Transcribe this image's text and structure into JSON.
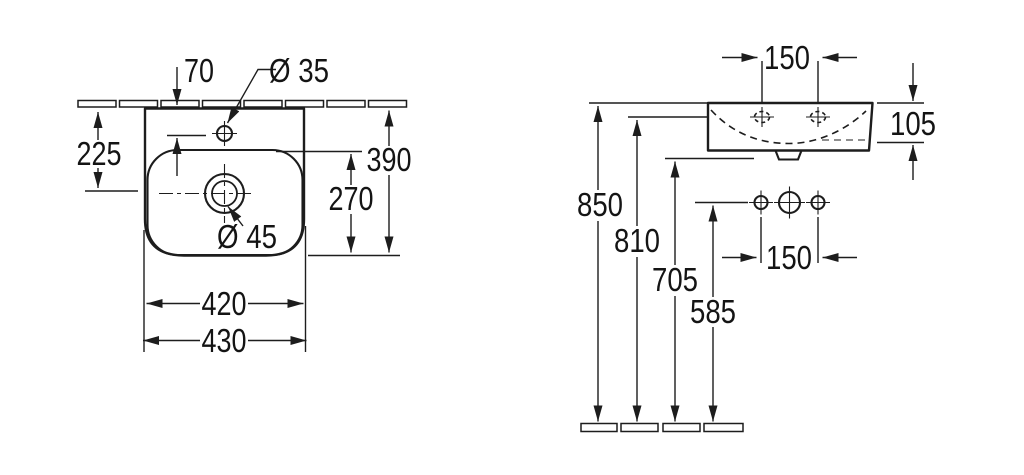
{
  "drawing": {
    "kind": "washbasin technical dimension drawing",
    "units": "mm",
    "line_color": "#1d1d1d",
    "background": "#ffffff"
  },
  "plan_view": {
    "name": "plan view (top)",
    "labels": {
      "tap_hole_setback": "70",
      "tap_hole_diameter": "Ø 35",
      "wall_to_drain": "225",
      "overall_depth": "390",
      "bowl_depth": "270",
      "drain_diameter": "Ø 45",
      "bowl_width": "420",
      "overall_width": "430"
    }
  },
  "front_view": {
    "name": "front elevation",
    "labels": {
      "tap_hole_spacing": "150",
      "apron_height": "105",
      "rim_height": "850",
      "tap_hole_height": "810",
      "outlet_height": "705",
      "fitting_height": "585",
      "fitting_spacing": "150"
    }
  }
}
